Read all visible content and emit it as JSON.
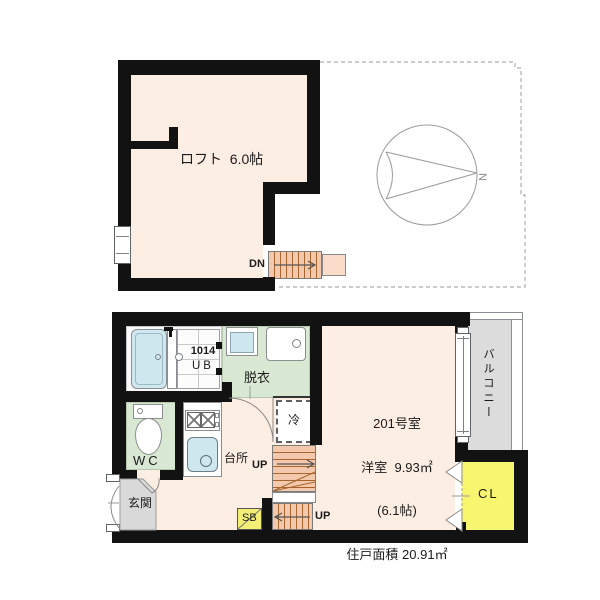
{
  "colors": {
    "wall": "#121212",
    "floor_main": "#fdeee3",
    "floor_wet": "#d9e8d2",
    "water_fixture": "#cfe7ef",
    "stairs": "#f4c8ad",
    "stairs_landing": "#f9ddca",
    "closet_yellow": "#f8f66e",
    "shoebox_yellow": "#f3ef75",
    "balcony_floor": "#dcdcdc",
    "entrance_floor": "#d9d9d9"
  },
  "upper_floor": {
    "loft_label": "ロフト  6.0帖",
    "stairs_down_label": "DN",
    "compass_label": "N"
  },
  "lower_floor": {
    "room_number": "201号室",
    "room_type_area": "洋室  9.93㎡",
    "room_tatami": "(6.1帖)",
    "total_area": "住戸面積 20.91㎡",
    "unit_bath_model": "1014",
    "unit_bath_label": "UB",
    "dressing_label": "脱衣",
    "wc_label": "WC",
    "kitchen_label": "台所",
    "entrance_label": "玄関",
    "fridge_label": "冷",
    "stairs_up_label_1": "UP",
    "stairs_up_label_2": "UP",
    "shoebox_label": "SB",
    "closet_label": "CL",
    "balcony_label": "バルコニー"
  }
}
